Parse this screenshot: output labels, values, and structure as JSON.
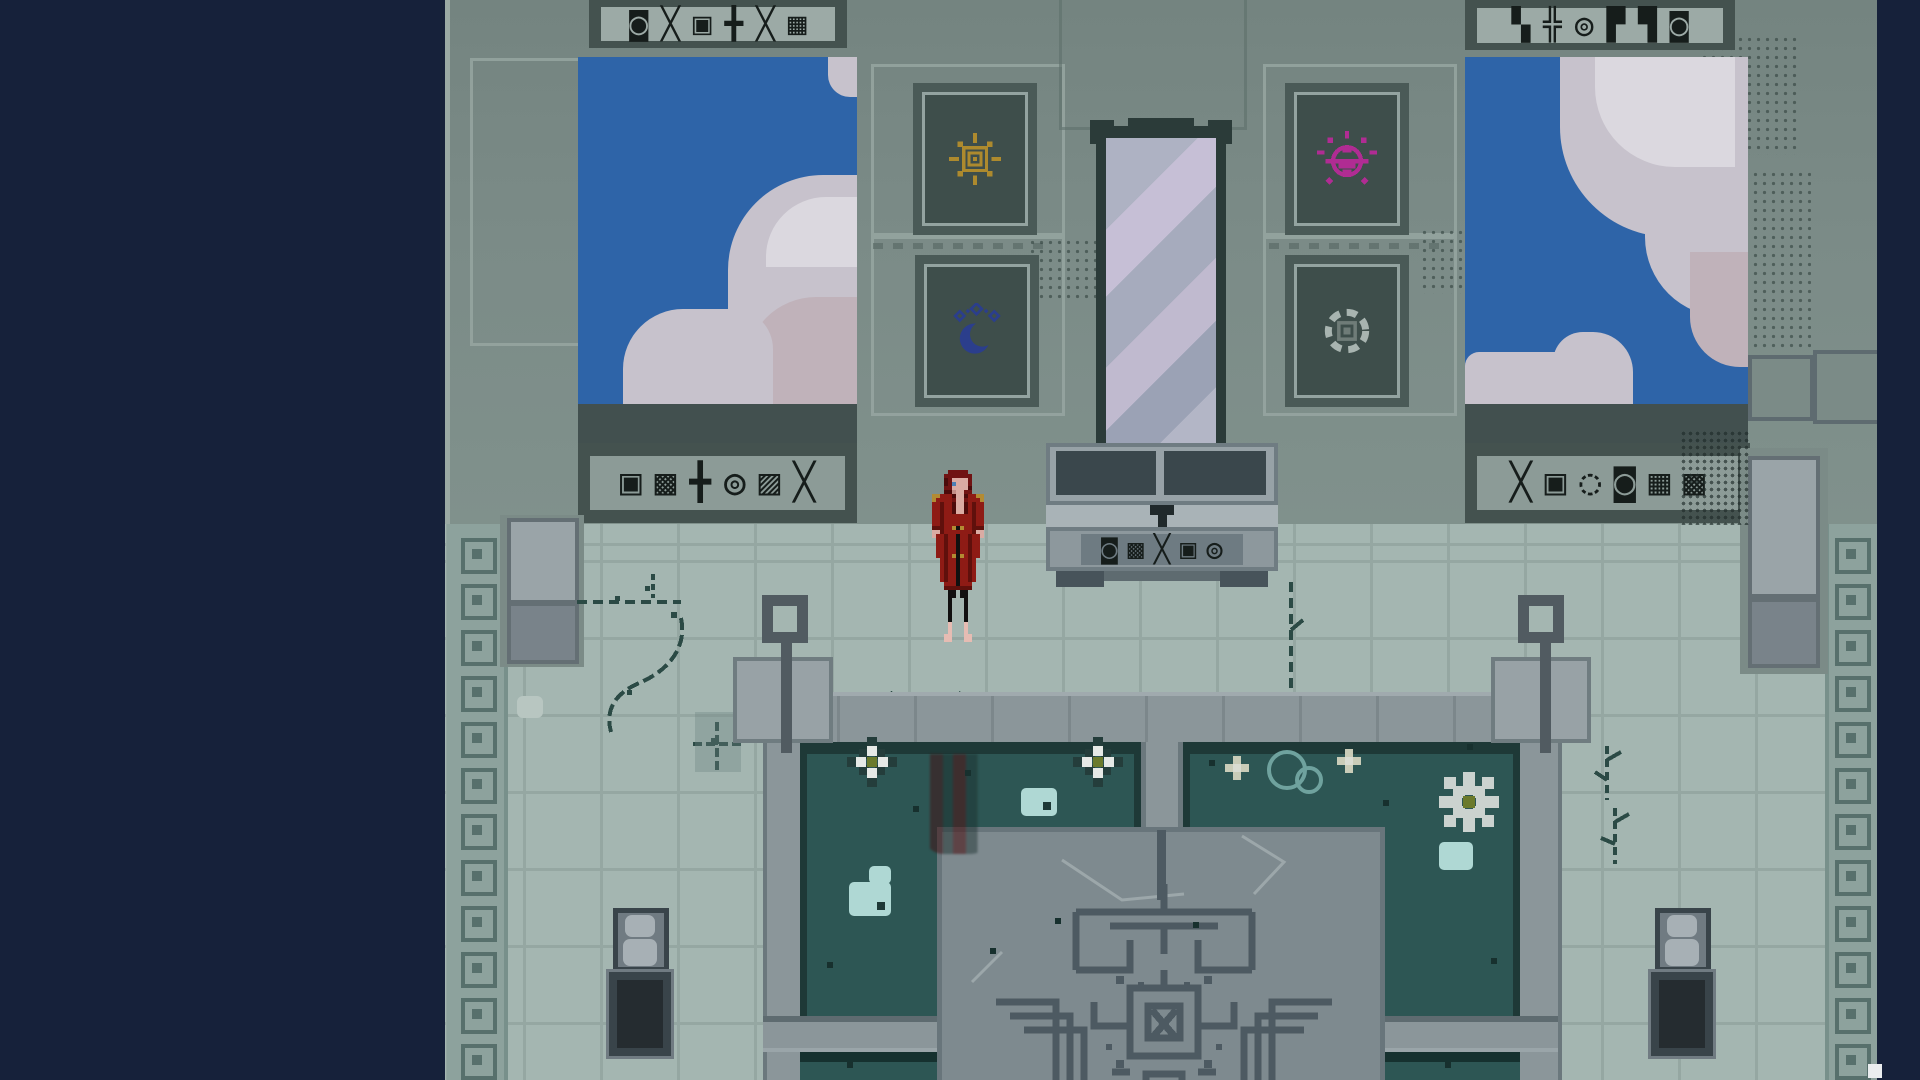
{
  "meta": {
    "app": "pixel-art-adventure-game",
    "scene": "temple sanctum with mirror, rune banners and reflecting pools",
    "view": "fullscreen game viewport, letterboxed on navy background"
  },
  "palette": {
    "letterbox_navy": "#16213A",
    "wall": "#7B8B87",
    "frieze_band": "#44524F",
    "frieze_panel": "#9CAAA6",
    "glyph_ink": "#161D1B",
    "sky_blue": "#2E64A8",
    "cloud": "#C7C2CC",
    "banner_field": "#3E4E4B",
    "sun_gold": "#AD8A2E",
    "moon_blue": "#2B3E8C",
    "scarab_pink": "#B02C93",
    "ring_gray": "#A8B4B0",
    "mirror_glass": "#AEB2C3",
    "floor": "#A4B6B1",
    "walkway": "#8B969A",
    "pool_water": "#2D5654",
    "pool_border": "#1E3937",
    "plaza": "#7E8A8F",
    "maze_line": "#4D5A62",
    "robe_red": "#8E1B15",
    "hair_red": "#701313"
  },
  "wall": {
    "friezes": {
      "top_left": "◙╳▣╋╳▦",
      "top_right": "▚╬◎▛▜◙",
      "mid_left": "▣▩╋◎▨╳",
      "mid_right": "╳▣◌◙▦▩"
    },
    "banners": [
      {
        "id": "sun-banner",
        "symbol": "sun-rune",
        "color": "#AD8A2E"
      },
      {
        "id": "moon-banner",
        "symbol": "crescent-moon-rune",
        "color": "#2B3E8C"
      },
      {
        "id": "scarab-banner",
        "symbol": "pink-scarab-rune",
        "color": "#B02C93"
      },
      {
        "id": "ring-banner",
        "symbol": "gray-ring-rune",
        "color": "#A8B4B0"
      }
    ]
  },
  "altar": {
    "glyphs": "◙▩╳▣◎",
    "keyhole": "T-shaped latch"
  },
  "character": {
    "name": "red-robed long-haired figure",
    "state": "standing on floor left of altar, facing viewer",
    "reflection": "blurred red reflection in pool below"
  },
  "decor": {
    "edge_squares": {
      "xs": [
        16,
        1390
      ],
      "start_y": 538,
      "step": 46,
      "count": 12
    },
    "pool_items": [
      {
        "type": "flower8",
        "x": 422,
        "y": 757
      },
      {
        "type": "flower8",
        "x": 648,
        "y": 757
      },
      {
        "type": "pad pad-dot",
        "x": 576,
        "y": 788,
        "w": 36,
        "h": 28
      },
      {
        "type": "pad",
        "x": 424,
        "y": 866,
        "w": 22,
        "h": 18
      },
      {
        "type": "pad pad-dot",
        "x": 404,
        "y": 882,
        "w": 42,
        "h": 34
      },
      {
        "type": "speck",
        "x": 468,
        "y": 806
      },
      {
        "type": "speck",
        "x": 545,
        "y": 948
      },
      {
        "type": "speck",
        "x": 382,
        "y": 962
      },
      {
        "type": "speck",
        "x": 610,
        "y": 918
      },
      {
        "type": "speck",
        "x": 520,
        "y": 770
      },
      {
        "type": "mini-flower",
        "x": 788,
        "y": 764
      },
      {
        "type": "mini-flower",
        "x": 900,
        "y": 757
      },
      {
        "type": "bubble",
        "x": 822,
        "y": 750,
        "w": 32,
        "h": 32
      },
      {
        "type": "bubble",
        "x": 850,
        "y": 766,
        "w": 20,
        "h": 20
      },
      {
        "type": "snowflake",
        "x": 1018,
        "y": 796
      },
      {
        "type": "pad",
        "x": 994,
        "y": 842,
        "w": 34,
        "h": 28
      },
      {
        "type": "speck",
        "x": 764,
        "y": 760
      },
      {
        "type": "speck",
        "x": 1022,
        "y": 744
      },
      {
        "type": "speck",
        "x": 938,
        "y": 800
      },
      {
        "type": "speck",
        "x": 748,
        "y": 922
      },
      {
        "type": "speck",
        "x": 1046,
        "y": 958
      },
      {
        "type": "speck",
        "x": 402,
        "y": 1062
      },
      {
        "type": "speck",
        "x": 1000,
        "y": 1062
      },
      {
        "type": "speck-light",
        "x": 72,
        "y": 696
      }
    ]
  }
}
